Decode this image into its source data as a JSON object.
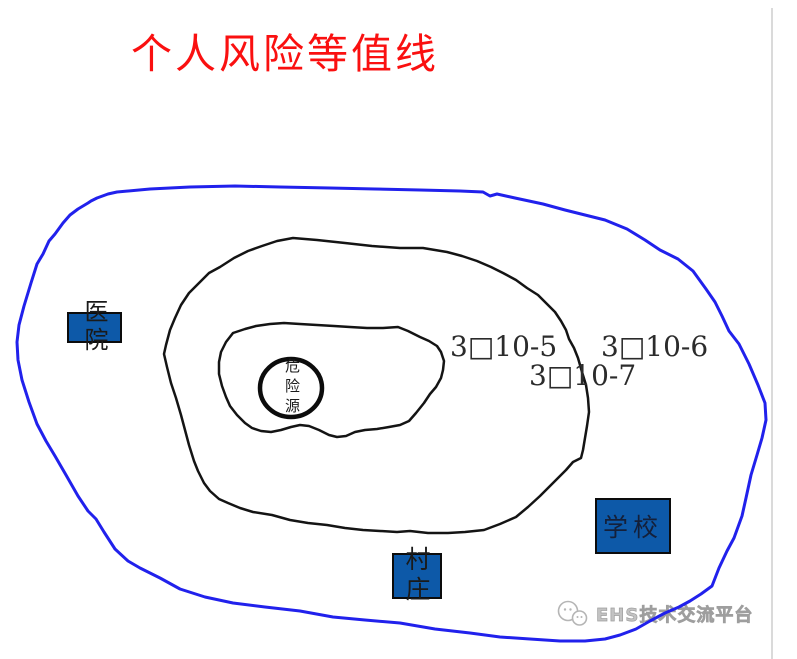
{
  "title": {
    "text": "个人风险等值线",
    "color": "#fa1010"
  },
  "contour_labels": [
    {
      "text": "3□10-5",
      "meaning": "individual risk 3x10^-5 contour"
    },
    {
      "text": "3□10-6",
      "meaning": "individual risk 3x10^-6 contour"
    },
    {
      "text": "3□10-7",
      "meaning": "individual risk 3x10^-7 contour"
    }
  ],
  "sites": {
    "hazard_source": "危险源",
    "hospital": "医院",
    "school": "学校",
    "village": "村庄"
  },
  "watermark": {
    "text": "EHS技术交流平台"
  },
  "colors": {
    "outer_contour": "#2121ec",
    "inner_contour": "#141414",
    "site_fill": "#0d59a8",
    "title_red": "#fa1010",
    "watermark_gray": "#b5b5b5"
  },
  "shapes": {
    "outer": "M117,192 L150,189 L190,187 L235,186 L280,187 L330,188 L375,189 L420,190 L460,191 L483,192 L490,196 L497,194 L515,198 L543,204 L565,210 L585,215 L605,220 L627,229 L645,240 L660,250 L678,259 L693,271 L706,289 L715,302 L722,316 L729,331 L739,344 L749,364 L758,385 L765,403 L766,420 L762,438 L757,455 L751,475 L746,498 L742,516 L734,538 L727,551 L719,568 L712,586 L701,594 L690,601 L679,607 L665,613 L650,621 L636,629 L620,635 L605,639 L585,641 L560,641 L530,639 L500,637 L470,633 L435,629 L400,623 L365,620 L333,617 L300,611 L265,607 L233,603 L205,597 L180,589 L160,578 L140,568 L128,561 L115,549 L104,532 L96,519 L88,511 L78,496 L66,475 L55,456 L46,441 L37,424 L29,402 L22,380 L18,360 L17,342 L19,325 L24,306 L31,283 L37,264 L43,254 L49,241 L55,234 L63,223 L70,215 L78,209 L88,203 L91,201 L97,198 L108,194 Z",
    "middle": "M293,238 L317,240 L345,243 L372,246 L400,248 L423,248 L447,252 L462,256 L477,261 L491,267 L503,273 L516,280 L527,288 L538,295 L547,304 L555,312 L561,321 L566,330 L569,339 L574,348 L578,358 L582,372 L586,385 L588,398 L589,412 L587,426 L585,438 L583,450 L581,458 L573,462 L566,470 L559,477 L549,487 L540,496 L528,507 L516,517 L500,524 L484,530 L465,532 L448,533 L428,533 L410,531 L397,532 L380,531 L363,530 L345,528 L327,525 L308,523 L290,520 L272,515 L253,512 L240,508 L228,503 L219,499 L210,491 L204,483 L198,471 L194,461 L189,445 L185,430 L181,415 L176,398 L171,383 L167,367 L164,354 L166,345 L170,330 L175,318 L181,305 L189,293 L199,283 L209,273 L220,267 L234,258 L248,251 L262,246 L277,241 Z",
    "inner": "M233,333 L245,329 L256,326 L270,324 L284,323 L300,324 L317,325 L334,326 L350,327 L367,328 L383,328 L398,327 L408,331 L420,337 L429,341 L437,346 L441,352 L444,361 L443,370 L441,378 L436,387 L430,394 L424,403 L416,413 L409,421 L400,425 L389,427 L377,429 L365,430 L355,432 L346,436 L337,437 L329,435 L319,430 L309,426 L300,425 L291,427 L281,430 L271,432 L261,431 L252,428 L245,423 L237,415 L230,406 L226,397 L222,386 L219,374 L219,362 L221,352 L226,342 Z"
  }
}
